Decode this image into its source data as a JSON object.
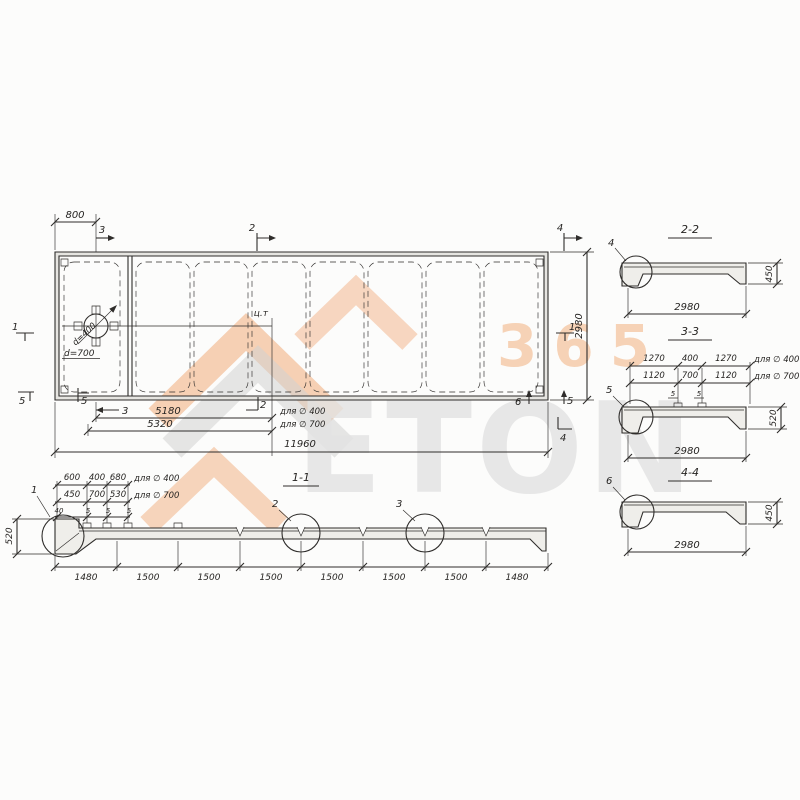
{
  "watermark": {
    "brand": "ETON",
    "badge": "365",
    "orange": "#f0a36d",
    "gray": "#d2d2d2"
  },
  "plan": {
    "dims": {
      "left_offset": "800",
      "height": "2980",
      "to_ct_d400": "5180",
      "to_ct_d700": "5320",
      "total": "11960"
    },
    "notes": {
      "for_d400": "для ∅ 400",
      "for_d700": "для ∅ 700"
    },
    "hole": {
      "d400": "d=400",
      "d700": "d=700"
    },
    "center_label": "ц.т",
    "marks": {
      "top3": "3",
      "top2": "2",
      "top4": "4",
      "left1": "1",
      "right1": "1",
      "left5a": "5",
      "left5b": "5",
      "bot3": "3",
      "bot2": "2",
      "bot6": "6",
      "bot5": "5",
      "bot4": "4"
    }
  },
  "s11": {
    "title": "1-1",
    "row400": [
      "600",
      "400",
      "680"
    ],
    "row400_note": "для ∅ 400",
    "row700": [
      "450",
      "700",
      "530"
    ],
    "row700_note": "для ∅ 700",
    "row_small": [
      "40",
      "5",
      "5",
      "5"
    ],
    "height": "520",
    "bottom": [
      "1480",
      "1500",
      "1500",
      "1500",
      "1500",
      "1500",
      "1500",
      "1480"
    ],
    "det1": "1",
    "det2": "2",
    "det3": "3"
  },
  "s22": {
    "title": "2-2",
    "det": "4",
    "width": "2980",
    "height": "450"
  },
  "s33": {
    "title": "3-3",
    "det": "5",
    "width": "2980",
    "height": "520",
    "row400": [
      "1270",
      "400",
      "1270"
    ],
    "row400_note": "для ∅ 400",
    "row700": [
      "1120",
      "700",
      "1120"
    ],
    "row700_note": "для ∅ 700",
    "off1": "5",
    "off2": "5"
  },
  "s44": {
    "title": "4-4",
    "det": "6",
    "width": "2980",
    "height": "450"
  }
}
